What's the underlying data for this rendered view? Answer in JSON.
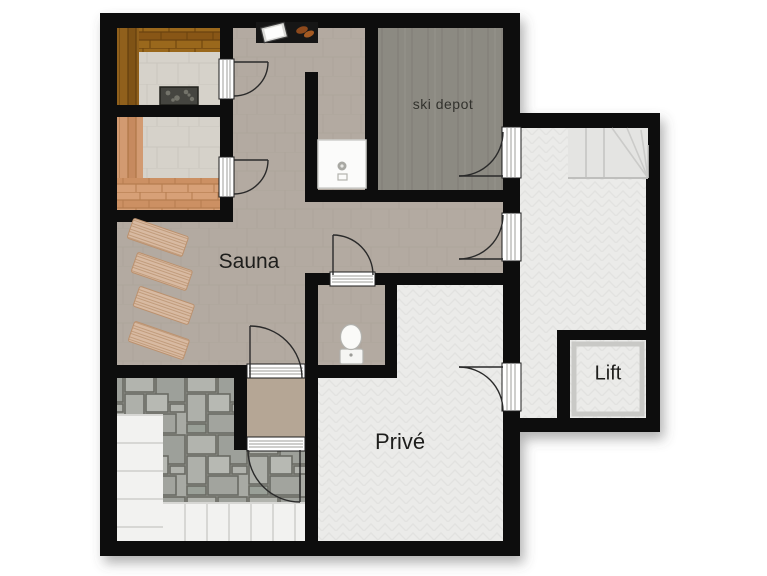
{
  "rooms": {
    "sauna": {
      "label": "Sauna"
    },
    "ski_depot": {
      "label": "ski depot"
    },
    "prive": {
      "label": "Privé"
    },
    "lift": {
      "label": "Lift"
    }
  },
  "features": {
    "stairs_hall": "winder-staircase",
    "stairs_entry": "l-shaped-staircase",
    "vestibule": "double-door-heat-lock",
    "fixtures": [
      "toilet",
      "shower-tray",
      "sauna-heater",
      "reception-desk",
      "laptop",
      "sun-loungers-x4"
    ],
    "door_count": 8
  },
  "colors": {
    "wall": "#0e0e0e",
    "floor_taupe": "#b3aaa1",
    "floor_ski_depot": "#8c8a82",
    "floor_white_herringbone": "#ebebe9",
    "floor_stone": "#a8aaa4",
    "floor_cabin_tile": "#d6d2ca",
    "wood_dark": "#9a671d",
    "wood_salmon": "#d7a077",
    "vestibule_tan": "#b5a695",
    "stairs_white": "#f2f2f0",
    "label_text": "#1e1e1c"
  }
}
